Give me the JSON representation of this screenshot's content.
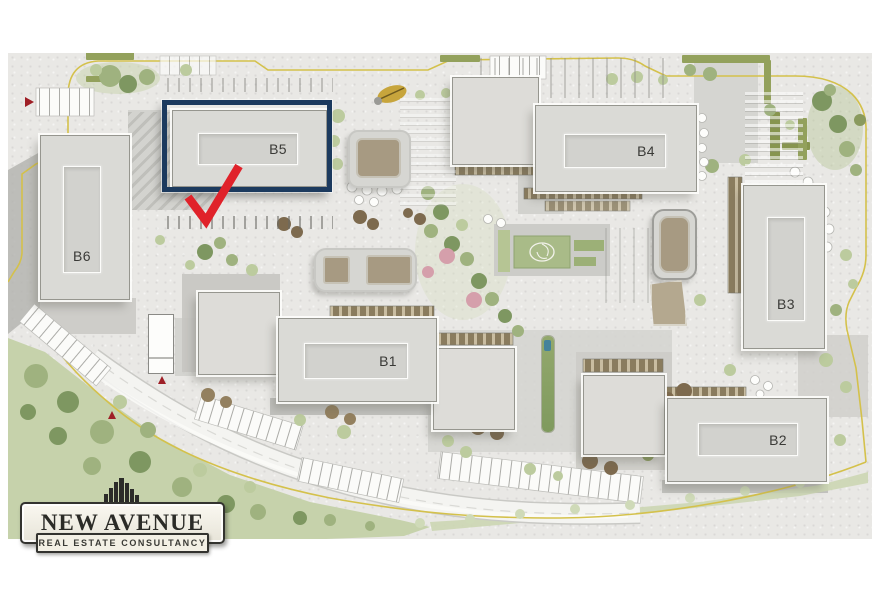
{
  "site_plan": {
    "buildings": {
      "b1": {
        "label": "B1"
      },
      "b2": {
        "label": "B2"
      },
      "b3": {
        "label": "B3"
      },
      "b4": {
        "label": "B4"
      },
      "b5": {
        "label": "B5"
      },
      "b6": {
        "label": "B6"
      }
    },
    "highlight": {
      "building_label": "B5",
      "box_color": "#1c3a5e",
      "arrow_color": "#e0222a"
    },
    "boundary_color": "#d4c14b"
  },
  "logo": {
    "name": "NEW AVENUE",
    "tagline": "REAL ESTATE CONSULTANCY"
  }
}
